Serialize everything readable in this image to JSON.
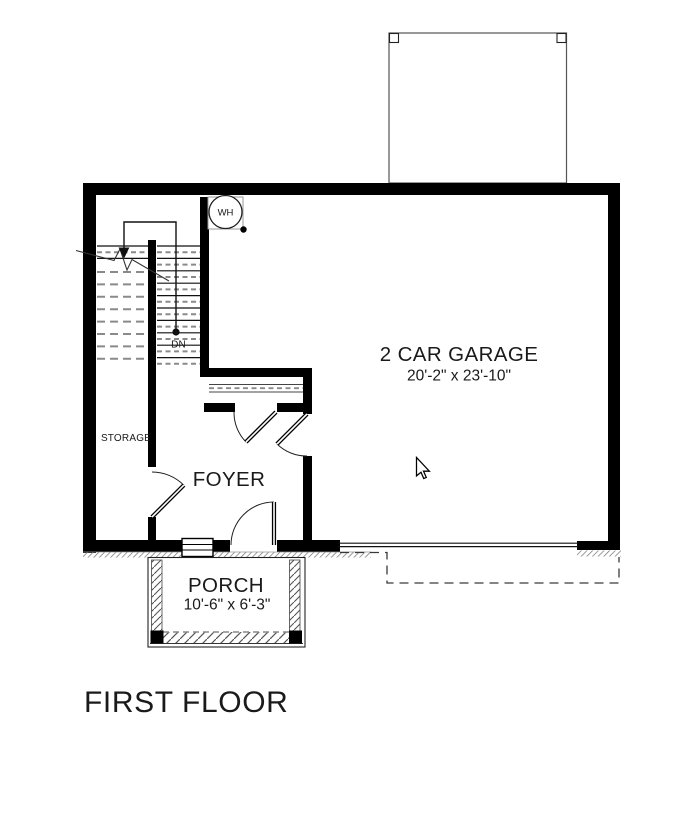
{
  "plan": {
    "title": "FIRST FLOOR",
    "rooms": {
      "garage": {
        "label": "2 CAR GARAGE",
        "dimensions": "20'-2\" x 23'-10\""
      },
      "foyer": {
        "label": "FOYER"
      },
      "storage": {
        "label": "STORAGE"
      },
      "porch": {
        "label": "PORCH",
        "dimensions": "10'-6\" x 6'-3\""
      }
    },
    "annotations": {
      "water_heater": "WH",
      "stairs_down": "DN"
    },
    "colors": {
      "wall": "#000000",
      "dashed_gray": "#8a8a8a",
      "hatch_gray": "#6f6f6f",
      "text": "#1a1a1a",
      "background": "#ffffff"
    }
  }
}
